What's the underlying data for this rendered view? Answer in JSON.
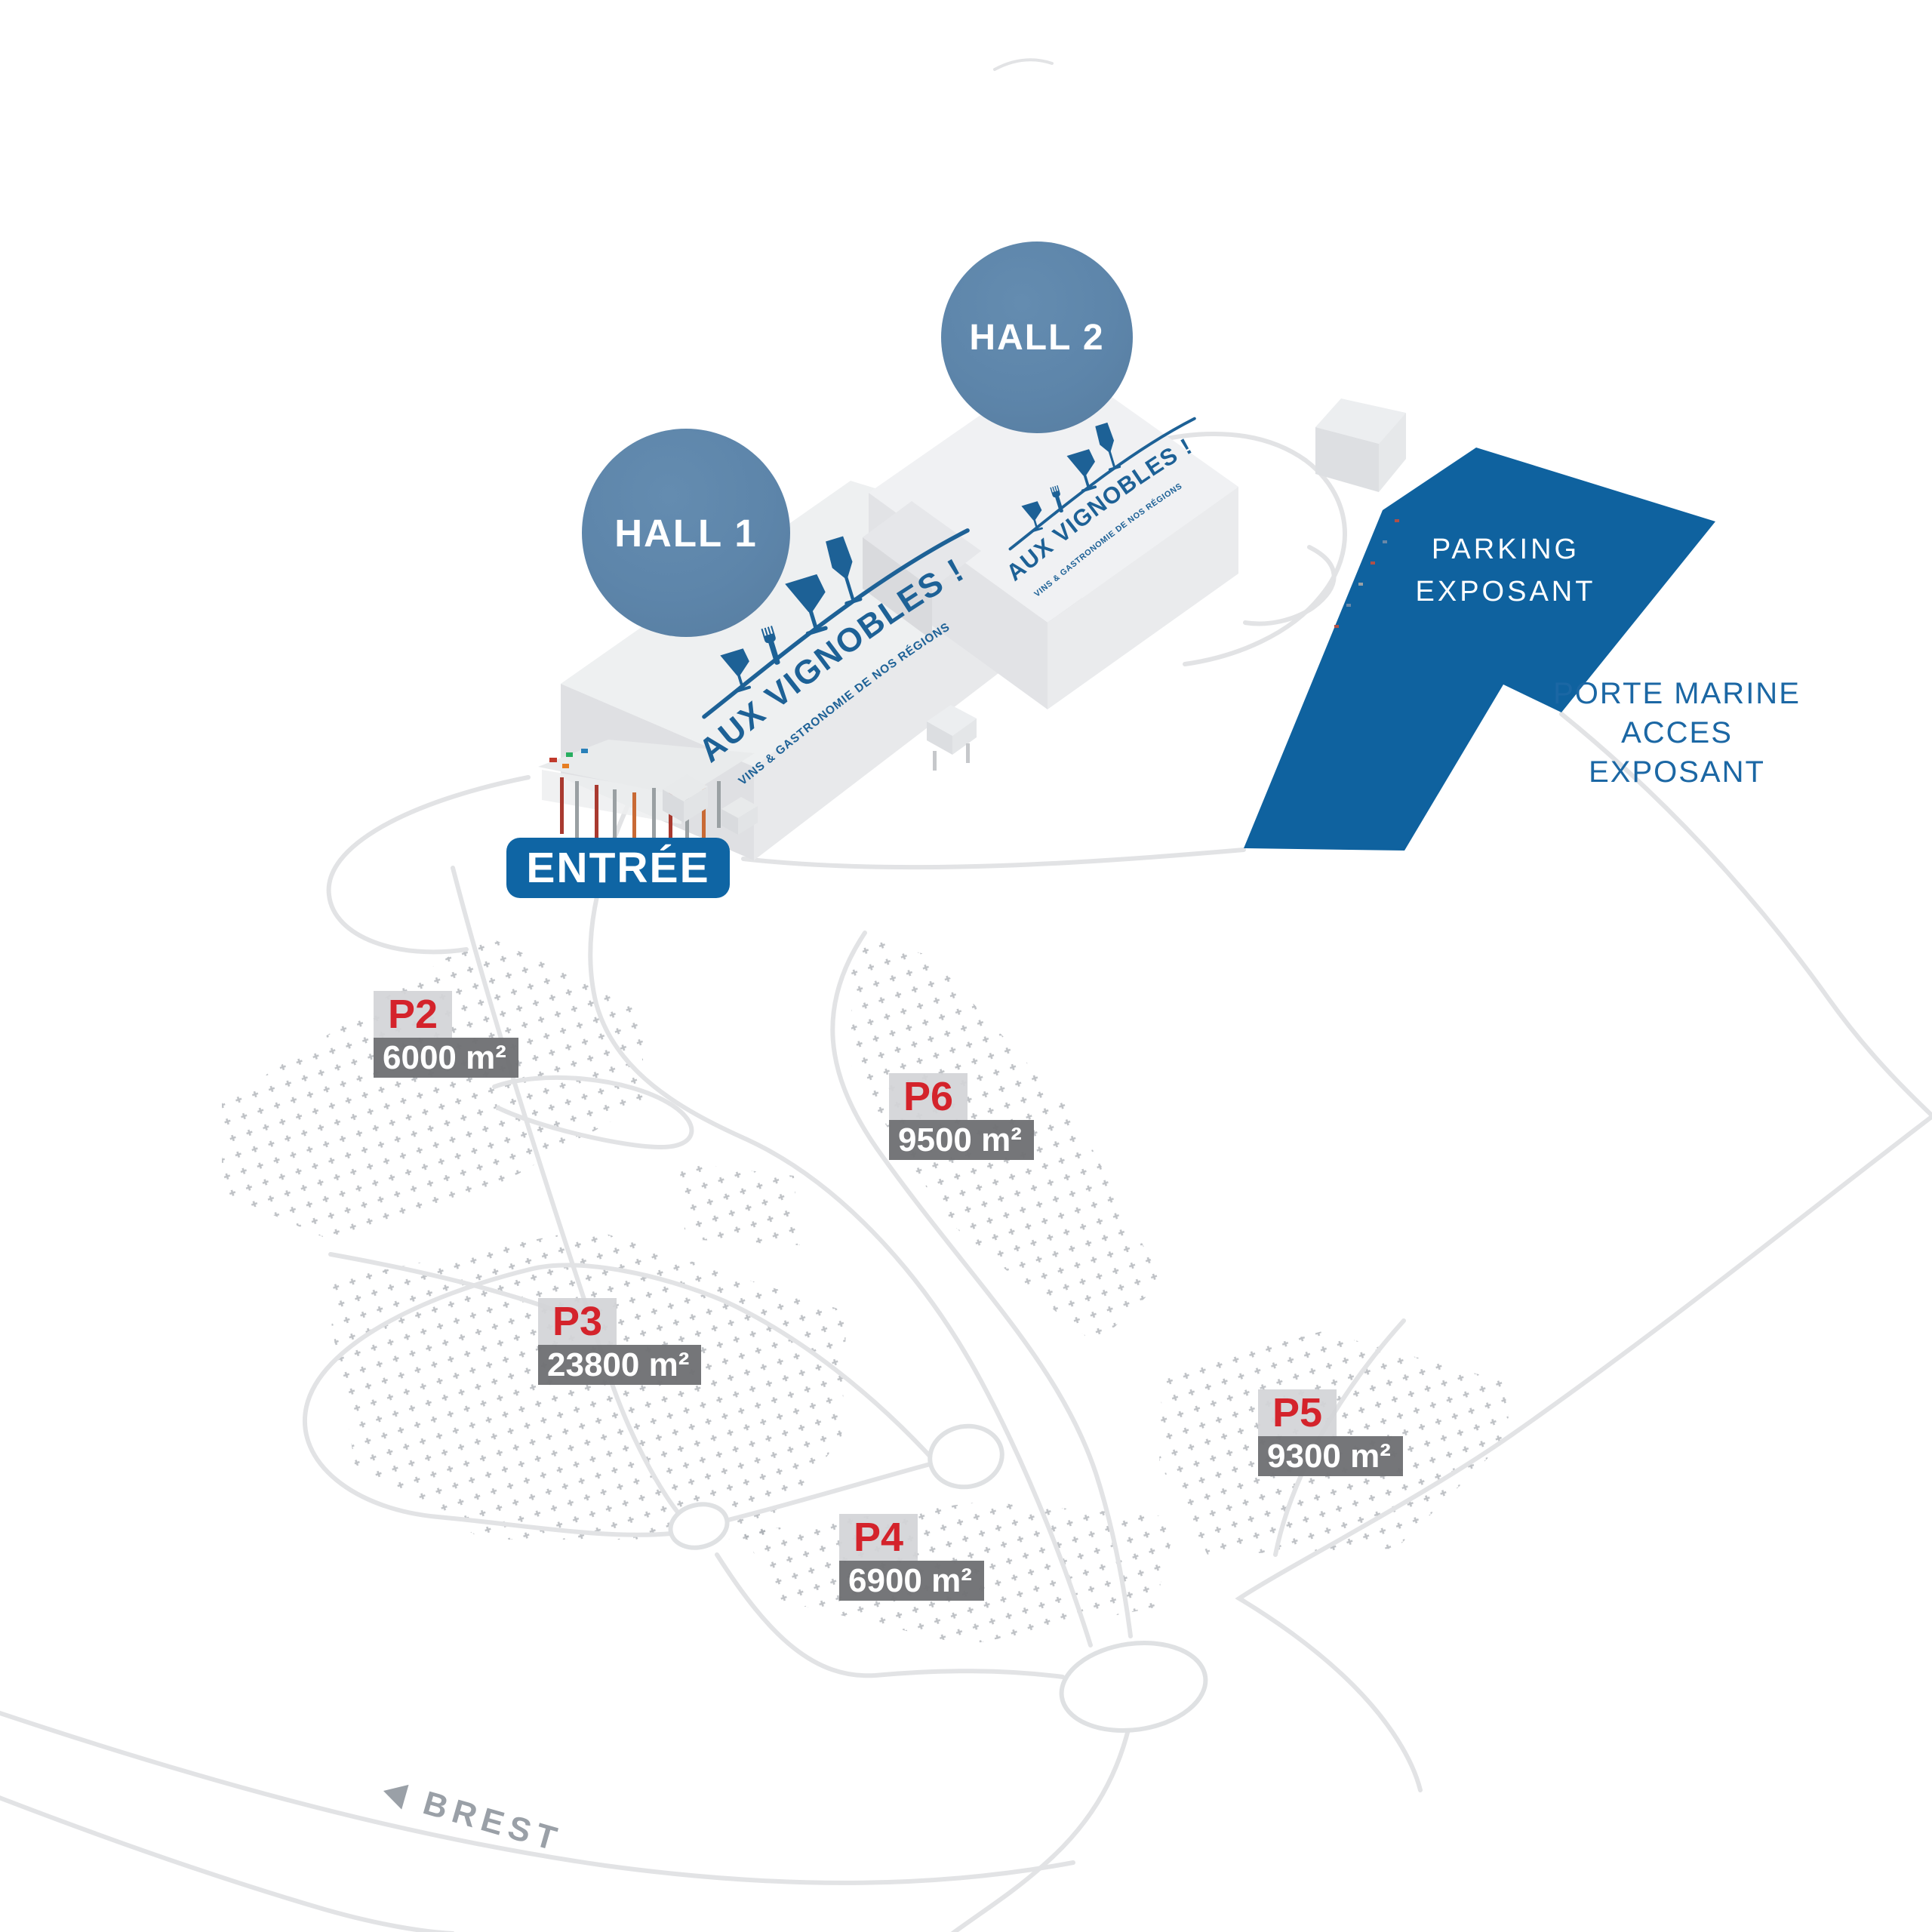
{
  "map": {
    "halls": [
      {
        "id": "hall-1",
        "label": "HALL 1"
      },
      {
        "id": "hall-2",
        "label": "HALL 2"
      }
    ],
    "entrance_label": "ENTRÉE",
    "exhibitor_parking": {
      "line1": "PARKING",
      "line2": "EXPOSANT"
    },
    "gate": {
      "line1": "PORTE MARINE",
      "line2": "ACCES EXPOSANT"
    },
    "parkings": [
      {
        "id": "P2",
        "area": "6000 m²"
      },
      {
        "id": "P6",
        "area": "9500 m²"
      },
      {
        "id": "P3",
        "area": "23800 m²"
      },
      {
        "id": "P5",
        "area": "9300 m²"
      },
      {
        "id": "P4",
        "area": "6900 m²"
      }
    ],
    "road_sign": {
      "city": "BREST"
    },
    "logo": {
      "title": "AUX VIGNOBLES !",
      "subtitle": "VINS & GASTRONOMIE DE NOS RÉGIONS"
    },
    "colors": {
      "primary_blue": "#0f65a4",
      "circle_blue": "#5d85aa",
      "logo_blue": "#1d6196",
      "accent_red": "#d4232b",
      "area_gray": "#6f7074",
      "label_gray": "#d3d4d7",
      "road_gray": "#e2e3e5",
      "text_gray": "#9aa0a7"
    }
  }
}
